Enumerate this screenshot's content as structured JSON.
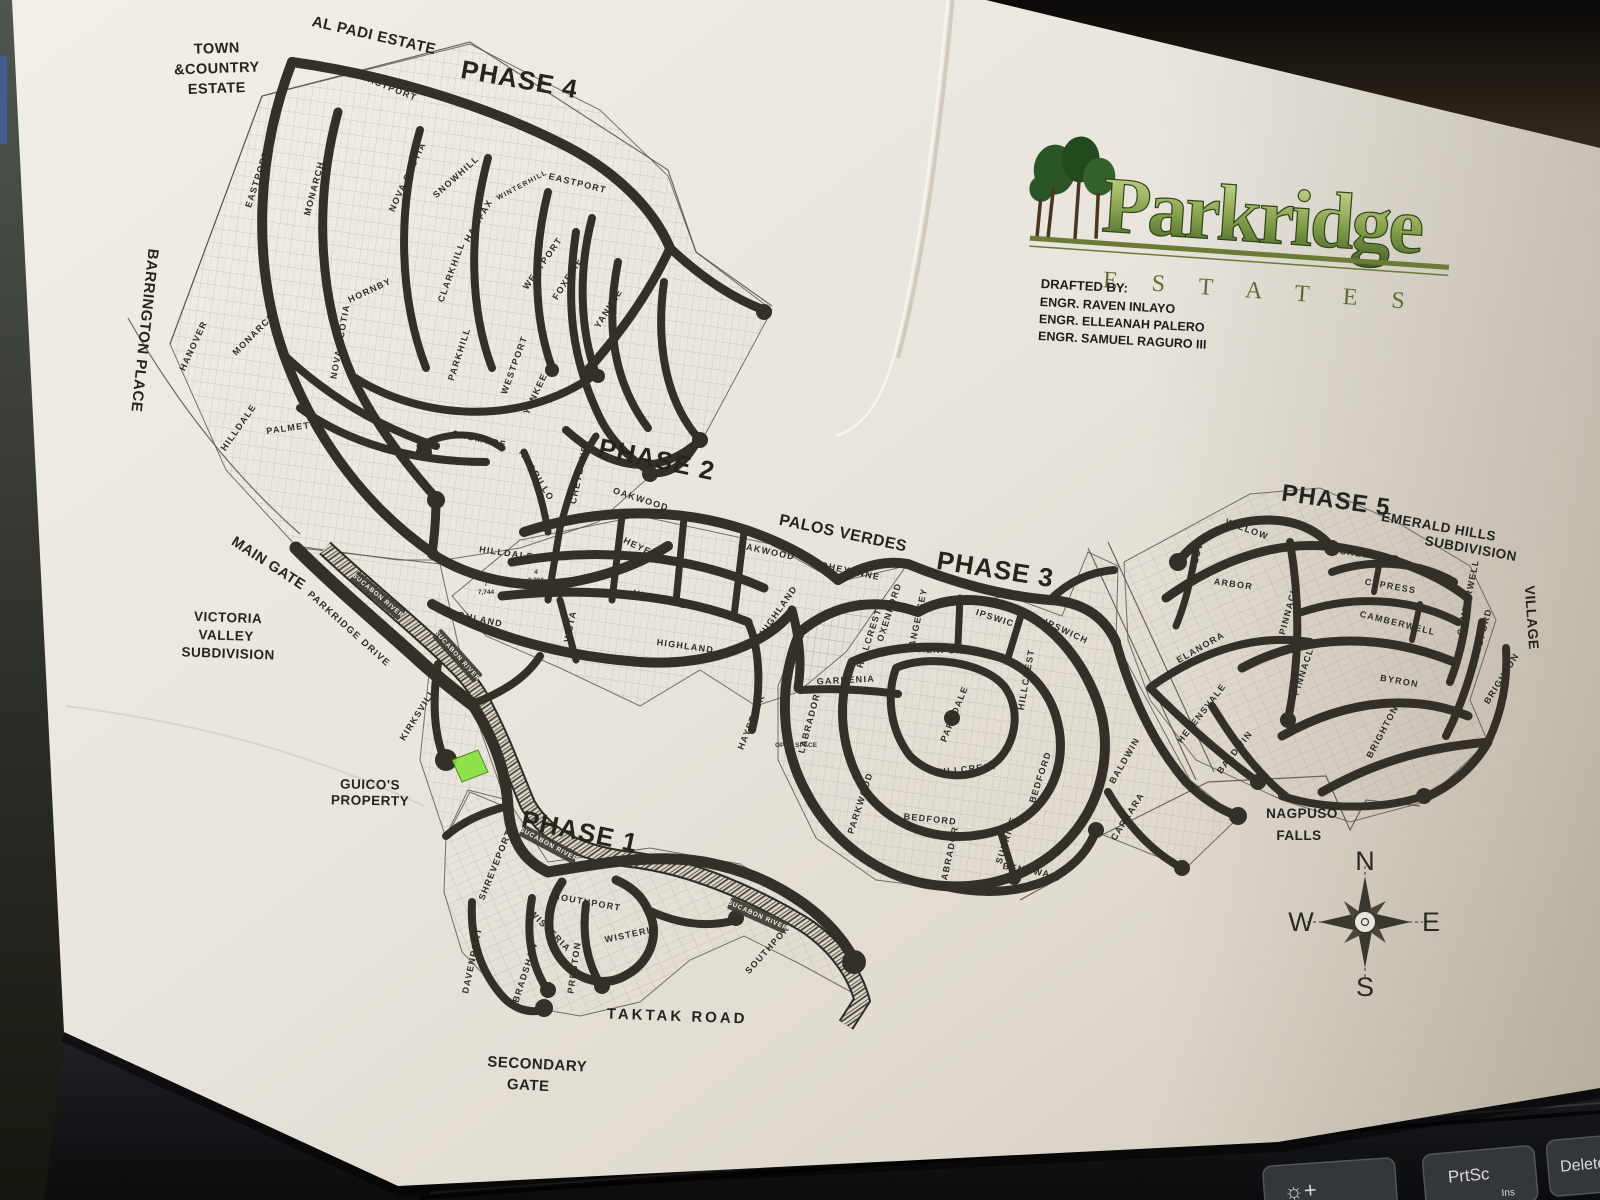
{
  "logo": {
    "name": "Parkridge",
    "subtitle": "E  S  T  A  T  E  S"
  },
  "drafted_by": {
    "heading": "DRAFTED BY:",
    "engineer1": "ENGR. RAVEN INLAYO",
    "engineer2": "ENGR. ELLEANAH PALERO",
    "engineer3": "ENGR. SAMUEL RAGURO III"
  },
  "compass": {
    "n": "N",
    "e": "E",
    "s": "S",
    "w": "W"
  },
  "keyboard": {
    "brightness_label": "☼+",
    "prtsc_label": "PrtSc",
    "prtsc_sub": "Ins",
    "delete_label": "Delete"
  },
  "colors": {
    "paper": "#e9e5dd",
    "road": "#343028",
    "logo_green_light": "#d6e09a",
    "logo_green_dark": "#3f5c22",
    "highlight_lot_green": "#86e23c"
  },
  "map": {
    "labels": [
      {
        "t": "AL PADI ESTATE",
        "k": "place",
        "x": 373,
        "y": 40,
        "r": 13,
        "s": 15
      },
      {
        "t": "TOWN",
        "k": "place",
        "x": 217,
        "y": 53,
        "r": -2
      },
      {
        "t": "&COUNTRY",
        "k": "place",
        "x": 217,
        "y": 73,
        "r": -2
      },
      {
        "t": "ESTATE",
        "k": "place",
        "x": 217,
        "y": 93,
        "r": -2
      },
      {
        "t": "BARRINGTON PLACE",
        "k": "place",
        "x": 140,
        "y": 330,
        "r": 96,
        "s": 15
      },
      {
        "t": "MAIN GATE",
        "k": "place",
        "x": 266,
        "y": 567,
        "r": 33
      },
      {
        "t": "VICTORIA",
        "k": "place",
        "x": 228,
        "y": 622,
        "r": 2,
        "s": 13.5
      },
      {
        "t": "VALLEY",
        "k": "place",
        "x": 226,
        "y": 640,
        "r": 2,
        "s": 13.5
      },
      {
        "t": "SUBDIVISION",
        "k": "place",
        "x": 228,
        "y": 658,
        "r": 2,
        "s": 13.5
      },
      {
        "t": "GUICO'S",
        "k": "place",
        "x": 370,
        "y": 789,
        "r": 1,
        "s": 13.5
      },
      {
        "t": "PROPERTY",
        "k": "place",
        "x": 370,
        "y": 805,
        "r": 1,
        "s": 13.5
      },
      {
        "t": "SECONDARY",
        "k": "place",
        "x": 537,
        "y": 1069,
        "r": 3,
        "s": 15
      },
      {
        "t": "GATE",
        "k": "place",
        "x": 528,
        "y": 1090,
        "r": 3,
        "s": 15
      },
      {
        "t": "TAKTAK  ROAD",
        "k": "place",
        "x": 677,
        "y": 1021,
        "r": 2,
        "s": 15,
        "sp": 3
      },
      {
        "t": "PALOS VERDES",
        "k": "place",
        "x": 842,
        "y": 538,
        "r": 12,
        "s": 16
      },
      {
        "t": "EMERALD HILLS",
        "k": "place",
        "x": 1438,
        "y": 531,
        "r": 10,
        "s": 13.5
      },
      {
        "t": "SUBDIVISION",
        "k": "place",
        "x": 1470,
        "y": 553,
        "r": 10,
        "s": 13.5
      },
      {
        "t": "NAGPUSO",
        "k": "place",
        "x": 1302,
        "y": 818,
        "r": 0,
        "s": 13.5
      },
      {
        "t": "FALLS",
        "k": "place",
        "x": 1299,
        "y": 840,
        "r": 0,
        "s": 13.5
      },
      {
        "t": "VILLAGE",
        "k": "place",
        "x": 1527,
        "y": 618,
        "r": 86,
        "s": 14
      },
      {
        "t": "PHASE 4",
        "k": "phase",
        "x": 518,
        "y": 88,
        "r": 10
      },
      {
        "t": "PHASE 2",
        "k": "phase",
        "x": 655,
        "y": 468,
        "r": 12
      },
      {
        "t": "PHASE 3",
        "k": "phase",
        "x": 994,
        "y": 578,
        "r": 9
      },
      {
        "t": "PHASE 5",
        "k": "phase",
        "x": 1335,
        "y": 508,
        "r": 8,
        "s": 24
      },
      {
        "t": "PHASE 1",
        "k": "phase",
        "x": 578,
        "y": 840,
        "r": 12
      },
      {
        "t": "EASTPORT",
        "k": "street",
        "x": 260,
        "y": 180,
        "r": -72
      },
      {
        "t": "EASTPORT",
        "k": "street",
        "x": 388,
        "y": 90,
        "r": 22
      },
      {
        "t": "EASTPORT",
        "k": "street",
        "x": 577,
        "y": 186,
        "r": 14
      },
      {
        "t": "MONARCH",
        "k": "street",
        "x": 317,
        "y": 189,
        "r": -75
      },
      {
        "t": "MONARCH",
        "k": "street",
        "x": 256,
        "y": 336,
        "r": -45
      },
      {
        "t": "HANOVER",
        "k": "street",
        "x": 196,
        "y": 347,
        "r": -65
      },
      {
        "t": "HORNBY",
        "k": "street",
        "x": 371,
        "y": 293,
        "r": -25
      },
      {
        "t": "NOVA SCOTIA",
        "k": "street",
        "x": 410,
        "y": 178,
        "r": -65
      },
      {
        "t": "NOVA SCOTIA",
        "k": "street",
        "x": 343,
        "y": 342,
        "r": -80
      },
      {
        "t": "SNOWHILL",
        "k": "street",
        "x": 458,
        "y": 179,
        "r": -42
      },
      {
        "t": "HALIFAX",
        "k": "street",
        "x": 481,
        "y": 222,
        "r": -60
      },
      {
        "t": "WINTERHILL",
        "k": "street",
        "x": 523,
        "y": 187,
        "r": -28,
        "s": 7
      },
      {
        "t": "CLARKHILL",
        "k": "street",
        "x": 454,
        "y": 273,
        "r": -70
      },
      {
        "t": "PARKHILL",
        "k": "street",
        "x": 462,
        "y": 355,
        "r": -72
      },
      {
        "t": "WESTPORT",
        "k": "street",
        "x": 545,
        "y": 265,
        "r": -55
      },
      {
        "t": "WESTPORT",
        "k": "street",
        "x": 517,
        "y": 366,
        "r": -70
      },
      {
        "t": "FOXFIRE",
        "k": "street",
        "x": 570,
        "y": 280,
        "r": -58
      },
      {
        "t": "YANKEE",
        "k": "street",
        "x": 611,
        "y": 310,
        "r": -58
      },
      {
        "t": "YANKEE",
        "k": "street",
        "x": 538,
        "y": 395,
        "r": -65
      },
      {
        "t": "SAGMORE",
        "k": "street",
        "x": 479,
        "y": 442,
        "r": 12
      },
      {
        "t": "AMARILLO",
        "k": "street",
        "x": 534,
        "y": 477,
        "r": 58
      },
      {
        "t": "PALMETTO",
        "k": "street",
        "x": 296,
        "y": 430,
        "r": -8
      },
      {
        "t": "HILLDALE",
        "k": "street",
        "x": 241,
        "y": 429,
        "r": -55
      },
      {
        "t": "HILLDALE",
        "k": "street",
        "x": 506,
        "y": 556,
        "r": 8
      },
      {
        "t": "HILLDALE",
        "k": "street",
        "x": 659,
        "y": 602,
        "r": 14
      },
      {
        "t": "OAKWOOD",
        "k": "street",
        "x": 640,
        "y": 502,
        "r": 18
      },
      {
        "t": "OAKWOOD",
        "k": "street",
        "x": 766,
        "y": 554,
        "r": 12
      },
      {
        "t": "CHEYENNE",
        "k": "street",
        "x": 582,
        "y": 475,
        "r": -78
      },
      {
        "t": "CHEYENNE",
        "k": "street",
        "x": 643,
        "y": 552,
        "r": 25
      },
      {
        "t": "CHEYENNE",
        "k": "street",
        "x": 850,
        "y": 574,
        "r": 12
      },
      {
        "t": "HIGHLAND",
        "k": "street",
        "x": 474,
        "y": 621,
        "r": 12
      },
      {
        "t": "HIGHLAND",
        "k": "street",
        "x": 685,
        "y": 649,
        "r": 8
      },
      {
        "t": "HIGHLAND",
        "k": "street",
        "x": 781,
        "y": 612,
        "r": -55
      },
      {
        "t": "VISTA",
        "k": "street",
        "x": 573,
        "y": 627,
        "r": -78
      },
      {
        "t": "HAYSTACK",
        "k": "street",
        "x": 754,
        "y": 723,
        "r": -68
      },
      {
        "t": "IPSWICH",
        "k": "street",
        "x": 998,
        "y": 622,
        "r": 18
      },
      {
        "t": "IPSWICH",
        "k": "street",
        "x": 1065,
        "y": 634,
        "r": 25
      },
      {
        "t": "OXENFORD",
        "k": "street",
        "x": 941,
        "y": 653,
        "r": 2
      },
      {
        "t": "OXENFORD",
        "k": "street",
        "x": 892,
        "y": 613,
        "r": -72
      },
      {
        "t": "ANGELSEY",
        "k": "street",
        "x": 921,
        "y": 618,
        "r": -78
      },
      {
        "t": "HILLCREST",
        "k": "street",
        "x": 872,
        "y": 639,
        "r": -72
      },
      {
        "t": "HILLCREST",
        "k": "street",
        "x": 1029,
        "y": 680,
        "r": -80
      },
      {
        "t": "HILLCREST",
        "k": "street",
        "x": 967,
        "y": 772,
        "r": -6
      },
      {
        "t": "GARDENIA",
        "k": "street",
        "x": 846,
        "y": 683,
        "r": -3
      },
      {
        "t": "LABRADOR",
        "k": "street",
        "x": 812,
        "y": 724,
        "r": -75
      },
      {
        "t": "LABRADOR",
        "k": "street",
        "x": 952,
        "y": 857,
        "r": -78
      },
      {
        "t": "PARKWOOD",
        "k": "street",
        "x": 863,
        "y": 804,
        "r": -72
      },
      {
        "t": "PARKDALE",
        "k": "street",
        "x": 957,
        "y": 715,
        "r": -68
      },
      {
        "t": "BEDFORD",
        "k": "street",
        "x": 930,
        "y": 822,
        "r": 6
      },
      {
        "t": "BEDFORD",
        "k": "street",
        "x": 1043,
        "y": 778,
        "r": -72
      },
      {
        "t": "SUNRISE",
        "k": "street",
        "x": 1009,
        "y": 841,
        "r": -72
      },
      {
        "t": "BENOWA",
        "k": "street",
        "x": 1026,
        "y": 873,
        "r": 10
      },
      {
        "t": "BALDWIN",
        "k": "street",
        "x": 1127,
        "y": 762,
        "r": -60
      },
      {
        "t": "CARRARA",
        "k": "street",
        "x": 1130,
        "y": 818,
        "r": -58
      },
      {
        "t": "WILLOW",
        "k": "street",
        "x": 1246,
        "y": 532,
        "r": 20
      },
      {
        "t": "WILLOW",
        "k": "street",
        "x": 1198,
        "y": 562,
        "r": -75
      },
      {
        "t": "ARBOR",
        "k": "street",
        "x": 1233,
        "y": 587,
        "r": 8
      },
      {
        "t": "CRESCENT",
        "k": "street",
        "x": 1369,
        "y": 558,
        "r": 8
      },
      {
        "t": "CYPRESS",
        "k": "street",
        "x": 1390,
        "y": 589,
        "r": 10
      },
      {
        "t": "CAMBERWELL",
        "k": "street",
        "x": 1397,
        "y": 626,
        "r": 14
      },
      {
        "t": "CAMBERWELL",
        "k": "street",
        "x": 1471,
        "y": 598,
        "r": -78
      },
      {
        "t": "PINNACLE",
        "k": "street",
        "x": 1292,
        "y": 608,
        "r": -75
      },
      {
        "t": "PINNACLE",
        "k": "street",
        "x": 1307,
        "y": 669,
        "r": -72
      },
      {
        "t": "ELANORA",
        "k": "street",
        "x": 1202,
        "y": 650,
        "r": -30
      },
      {
        "t": "HELENSVALE",
        "k": "street",
        "x": 1204,
        "y": 715,
        "r": -52
      },
      {
        "t": "BALDWIN",
        "k": "street",
        "x": 1237,
        "y": 754,
        "r": -52
      },
      {
        "t": "BYRON",
        "k": "street",
        "x": 1399,
        "y": 684,
        "r": 10
      },
      {
        "t": "BRIGHTON",
        "k": "street",
        "x": 1504,
        "y": 680,
        "r": -58
      },
      {
        "t": "BRIGHTON",
        "k": "street",
        "x": 1385,
        "y": 733,
        "r": -62
      },
      {
        "t": "LANGFORD",
        "k": "street",
        "x": 1484,
        "y": 639,
        "r": -75
      },
      {
        "t": "PARKRIDGE DRIVE",
        "k": "street",
        "x": 347,
        "y": 631,
        "r": 42,
        "s": 9.5
      },
      {
        "t": "SHREVEPORT",
        "k": "street",
        "x": 498,
        "y": 866,
        "r": -68
      },
      {
        "t": "KIRKSVILLE",
        "k": "street",
        "x": 422,
        "y": 713,
        "r": -58
      },
      {
        "t": "SOUTHPORT",
        "k": "street",
        "x": 587,
        "y": 905,
        "r": 10
      },
      {
        "t": "SOUTHPORT",
        "k": "street",
        "x": 772,
        "y": 949,
        "r": -48
      },
      {
        "t": "WISTERIA",
        "k": "street",
        "x": 548,
        "y": 933,
        "r": 45
      },
      {
        "t": "WISTERIA",
        "k": "street",
        "x": 632,
        "y": 937,
        "r": -12
      },
      {
        "t": "PRESTON",
        "k": "street",
        "x": 577,
        "y": 968,
        "r": -82
      },
      {
        "t": "DAVENPORT",
        "k": "street",
        "x": 475,
        "y": 961,
        "r": -78
      },
      {
        "t": "BRADSHAW",
        "k": "street",
        "x": 528,
        "y": 973,
        "r": -72
      },
      {
        "t": "SUCABON RIVER",
        "k": "river",
        "x": 377,
        "y": 597,
        "r": 40
      },
      {
        "t": "SUCABON RIVER",
        "k": "river",
        "x": 456,
        "y": 657,
        "r": 48
      },
      {
        "t": "SUCABON RIVER",
        "k": "river",
        "x": 548,
        "y": 846,
        "r": 28
      },
      {
        "t": "SUCABON RIVER",
        "k": "river",
        "x": 757,
        "y": 917,
        "r": 24
      },
      {
        "t": "OPEN SPACE",
        "k": "tiny",
        "x": 796,
        "y": 747,
        "r": 0
      },
      {
        "t": "7",
        "k": "tiny",
        "x": 486,
        "y": 586,
        "r": 0
      },
      {
        "t": "7,744",
        "k": "tiny",
        "x": 486,
        "y": 594,
        "r": 0
      },
      {
        "t": "4",
        "k": "tiny",
        "x": 536,
        "y": 574,
        "r": 0
      },
      {
        "t": "2,266",
        "k": "tiny",
        "x": 536,
        "y": 582,
        "r": 0
      }
    ]
  }
}
